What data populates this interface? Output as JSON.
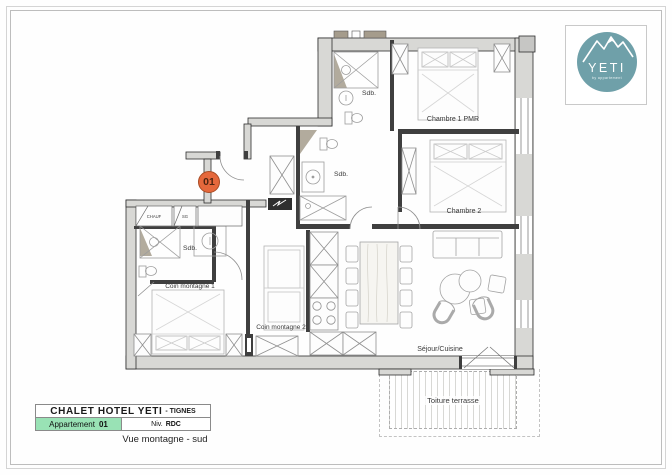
{
  "plan": {
    "unit_badge": "01",
    "rooms": {
      "sdb1": "Sdb.",
      "sdb2": "Sdb.",
      "sdb3": "Sdb.",
      "chambre1": "Chambre 1 PMR",
      "chambre2": "Chambre 2",
      "coin1": "Coin montagne 1",
      "coin2": "Coin montagne 2",
      "sejour": "Séjour/Cuisine",
      "terrasse": "Toiture terrasse",
      "chauf": "CHAUF",
      "sg": "SG"
    }
  },
  "logo": {
    "brand": "YETI",
    "tagline": "by appartement"
  },
  "title_block": {
    "hotel_name": "CHALET HOTEL YETI",
    "location": "- TIGNES",
    "apartment_label": "Appartement",
    "apartment_number": "01",
    "level_label": "Niv.",
    "level_value": "RDC",
    "caption": "Vue montagne - sud"
  },
  "colors": {
    "accent_orange": "#E5683C",
    "brand_teal": "#6FA0A9",
    "highlight_green": "#99E2B5"
  }
}
